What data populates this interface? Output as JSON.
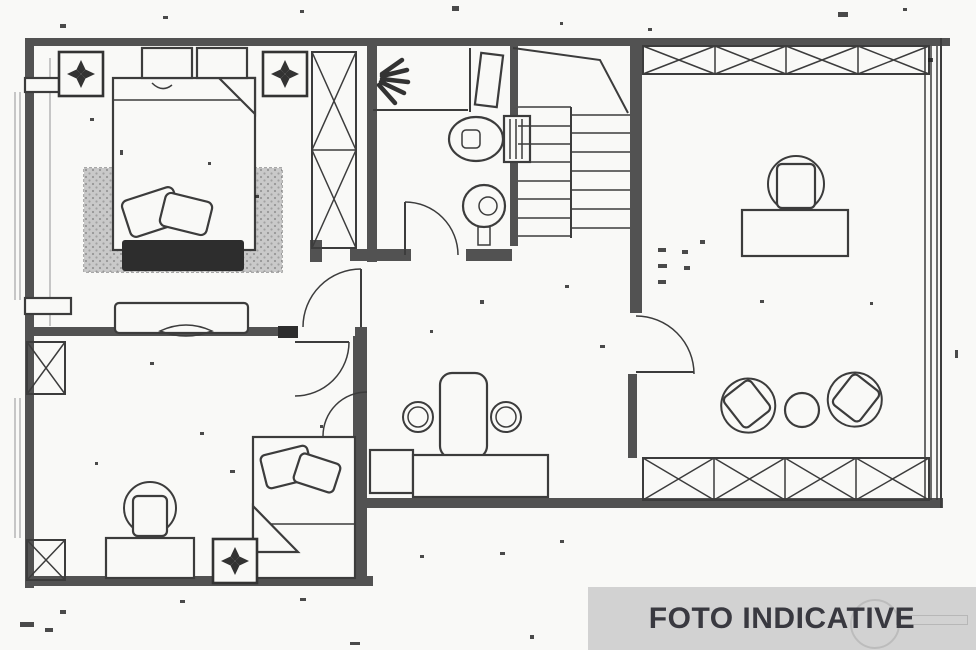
{
  "watermark": {
    "label": "FOTO INDICATIVE"
  },
  "palette": {
    "paper": "#f9f9f7",
    "ink": "#3c3c3c",
    "wall": "#525252",
    "dark": "#2d2d2d",
    "rug": "#c9c9c9",
    "band_bg": "#d2d2d2",
    "band_text": "#393940",
    "speck": "#1e1e1e",
    "light": "#a5a5a5"
  },
  "plan": {
    "type": "floor-plan",
    "icons": {
      "ceiling_light": "quatrefoil-in-square",
      "shower": "fan-rays",
      "toilet": "tank-and-bowl",
      "sink": "double-circle",
      "stairs": "double-flight-treads",
      "wardrobe": "x-crossed-box",
      "window_band": "x-crossed-strip",
      "door": "quarter-circle-swing"
    },
    "counts": {
      "ceiling_lights": 3,
      "beds": 2,
      "door_swings": 5,
      "x_band_cells_top": 4,
      "x_band_cells_bottom": 4
    }
  }
}
